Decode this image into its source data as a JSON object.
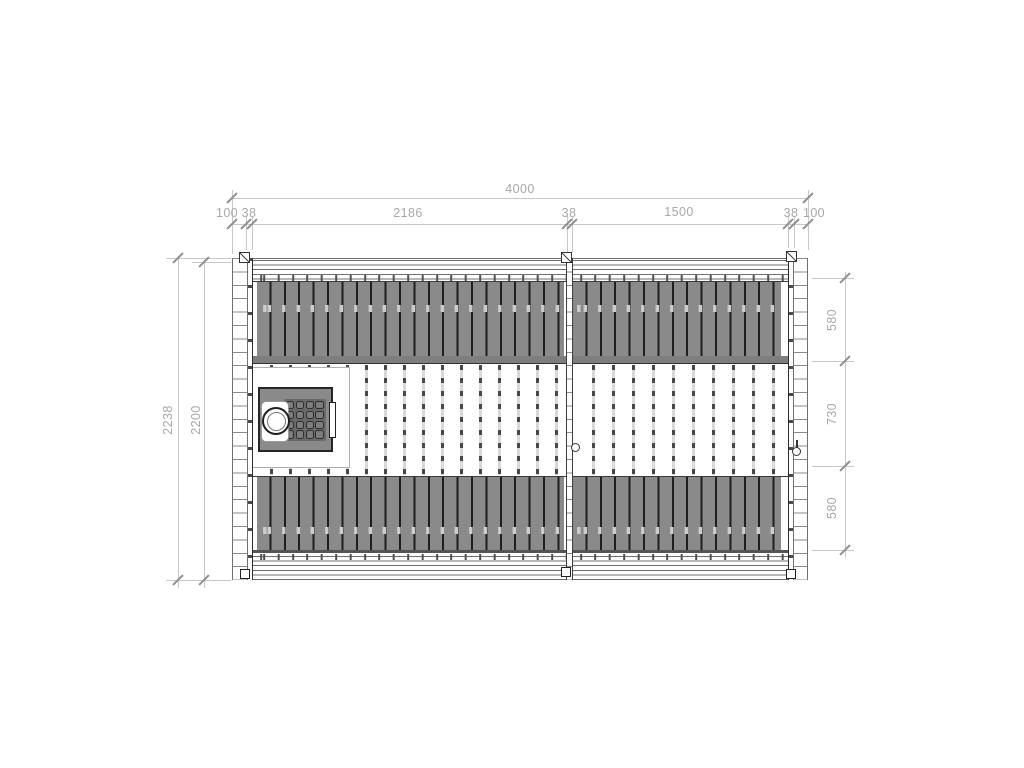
{
  "drawing": {
    "dims": {
      "total_width_label": "4000",
      "top_chain_labels": [
        "100",
        "38",
        "2186",
        "38",
        "1500",
        "38",
        "100"
      ],
      "left_outer_label": "2238",
      "left_inner_label": "2200",
      "right_chain_labels": [
        "580",
        "730",
        "580"
      ]
    },
    "icons": {
      "chimney_icon": "concentric-circles",
      "heater_stones_icon": "4x4-rounded-grid",
      "door_handle_icon": "small-circle",
      "corner_post_icon": "square-with-diagonal-slash"
    }
  },
  "colors": {
    "background": "#ffffff",
    "bench_fill": "#8a8a8a",
    "bench_gap": "#1f1f1f",
    "bench_highlight": "#cccccc",
    "stove_fill": "#8a8a8a",
    "stones_fill": "#696969",
    "wall_line": "#8a8a8a",
    "line_dark": "#2e2e2e",
    "dim_line": "#c8c8c8",
    "dim_tick": "#8f8f8f",
    "dim_text": "#a8a8a8"
  }
}
